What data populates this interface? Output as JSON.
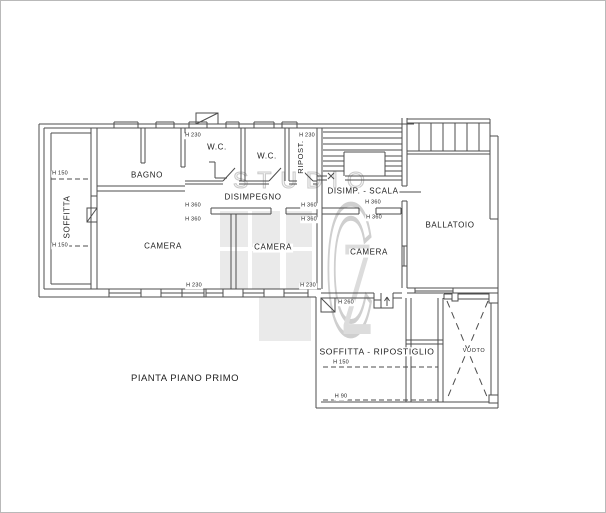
{
  "drawing": {
    "title": "PIANTA PIANO PRIMO",
    "watermark": {
      "word": "STUDIO",
      "letter_c": "C",
      "letter_z": "Z"
    },
    "room_labels": [
      {
        "name": "soffitta",
        "text": "SOFFITTA",
        "x": 67,
        "y": 216,
        "rotate": true,
        "size": 8
      },
      {
        "name": "bagno",
        "text": "BAGNO",
        "x": 146,
        "y": 175,
        "size": 8
      },
      {
        "name": "wc-1",
        "text": "W.C.",
        "x": 216,
        "y": 147,
        "size": 8
      },
      {
        "name": "wc-2",
        "text": "W.C.",
        "x": 266,
        "y": 156,
        "size": 8
      },
      {
        "name": "ripostiglio",
        "text": "RIPOST.",
        "x": 300,
        "y": 156,
        "rotate": true,
        "size": 7.5
      },
      {
        "name": "disimpegno",
        "text": "DISIMPEGNO",
        "x": 252,
        "y": 197,
        "size": 8
      },
      {
        "name": "disimpegno-scala",
        "text": "DISIMP. - SCALA",
        "x": 362,
        "y": 191,
        "size": 8
      },
      {
        "name": "camera-left",
        "text": "CAMERA",
        "x": 162,
        "y": 246,
        "size": 8
      },
      {
        "name": "camera-middle",
        "text": "CAMERA",
        "x": 272,
        "y": 247,
        "size": 8
      },
      {
        "name": "camera-right",
        "text": "CAMERA",
        "x": 368,
        "y": 252,
        "size": 8
      },
      {
        "name": "ballatoio",
        "text": "BALLATOIO",
        "x": 449,
        "y": 225,
        "size": 8
      },
      {
        "name": "soffitta-ripostiglio",
        "text": "SOFFITTA - RIPOSTIGLIO",
        "x": 376,
        "y": 351,
        "size": 8.5
      },
      {
        "name": "vuoto",
        "text": "VUOTO",
        "x": 473,
        "y": 350,
        "size": 5.5
      }
    ],
    "height_labels": [
      {
        "text": "H 150",
        "x": 59,
        "y": 173
      },
      {
        "text": "H 150",
        "x": 59,
        "y": 245
      },
      {
        "text": "H 230",
        "x": 192,
        "y": 135
      },
      {
        "text": "H 230",
        "x": 306,
        "y": 135
      },
      {
        "text": "H 360",
        "x": 192,
        "y": 205
      },
      {
        "text": "H 360",
        "x": 192,
        "y": 219
      },
      {
        "text": "H 360",
        "x": 308,
        "y": 205
      },
      {
        "text": "H 360",
        "x": 308,
        "y": 219
      },
      {
        "text": "H 360",
        "x": 372,
        "y": 202
      },
      {
        "text": "H 360",
        "x": 373,
        "y": 217
      },
      {
        "text": "H 230",
        "x": 193,
        "y": 285
      },
      {
        "text": "H 230",
        "x": 307,
        "y": 285
      },
      {
        "text": "H 260",
        "x": 345,
        "y": 302
      },
      {
        "text": "H 150",
        "x": 340,
        "y": 362
      },
      {
        "text": "H 90",
        "x": 340,
        "y": 396
      }
    ]
  }
}
